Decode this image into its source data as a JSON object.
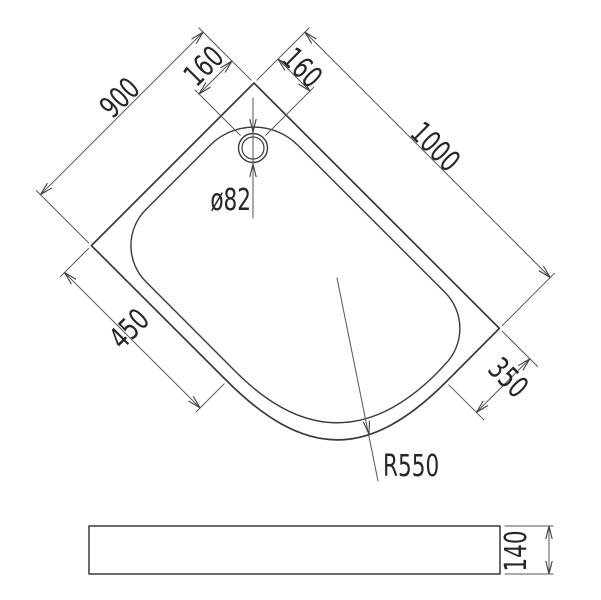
{
  "drawing": {
    "type": "shower-tray technical dimension drawing",
    "colors": {
      "background": "#ffffff",
      "outline": "#3a3a3a",
      "dimension_lines": "#555555",
      "text": "#262626"
    },
    "plan_view": {
      "labels": {
        "edge_left": "900",
        "edge_right": "1000",
        "drain_offset_left": "160",
        "drain_offset_right": "160",
        "drain_diameter": "ø82",
        "front_left_edge": "450",
        "front_right_edge": "350",
        "corner_radius": "R550"
      }
    },
    "side_view": {
      "labels": {
        "height": "140"
      }
    }
  }
}
